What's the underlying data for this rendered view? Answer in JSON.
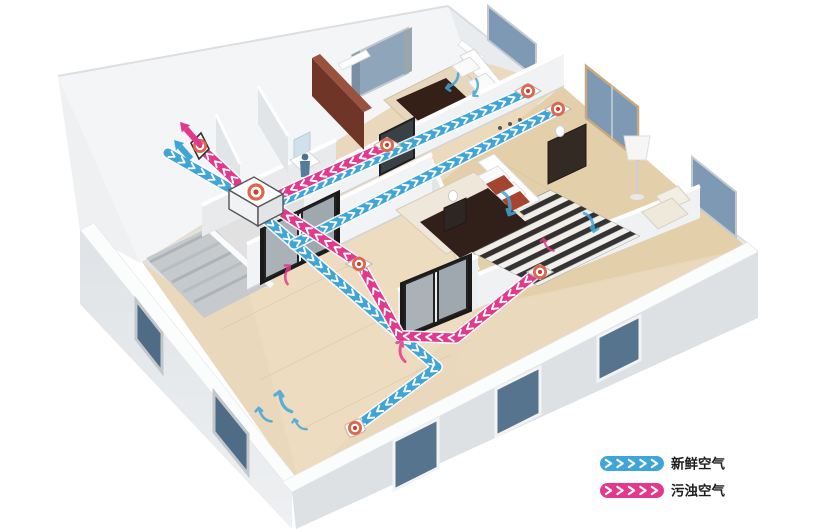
{
  "diagram": {
    "type": "home-ventilation-system-cutaway",
    "colors": {
      "fresh": "#3fa5d8",
      "exhaust": "#e2398c",
      "vent_ring": "#e0654e",
      "vent_dot": "#c9402e",
      "chevron": "#ffffff"
    },
    "legend": {
      "items": [
        {
          "id": "fresh-air",
          "label": "新鲜空气",
          "color": "#3fa5d8"
        },
        {
          "id": "exhaust-air",
          "label": "污浊空气",
          "color": "#e2398c"
        }
      ]
    },
    "unit": {
      "id": "heat-recovery-unit",
      "x": 256,
      "y": 192
    },
    "ducts": [
      {
        "id": "fresh-intake-duct",
        "type": "fresh",
        "points": [
          [
            168,
            153
          ],
          [
            238,
            193
          ]
        ]
      },
      {
        "id": "fresh-supply-living",
        "type": "fresh",
        "points": [
          [
            260,
            214
          ],
          [
            437,
            367
          ],
          [
            356,
            427
          ]
        ]
      },
      {
        "id": "fresh-supply-bedroom1",
        "type": "fresh",
        "points": [
          [
            264,
            209
          ],
          [
            527,
            92
          ]
        ]
      },
      {
        "id": "fresh-supply-bedroom2",
        "type": "fresh",
        "points": [
          [
            294,
            244
          ],
          [
            556,
            110
          ]
        ]
      },
      {
        "id": "exhaust-from-bathroom",
        "type": "exhaust",
        "points": [
          [
            386,
            146
          ],
          [
            268,
            200
          ]
        ]
      },
      {
        "id": "exhaust-from-master",
        "type": "exhaust",
        "points": [
          [
            539,
            271
          ],
          [
            456,
            338
          ],
          [
            400,
            336
          ],
          [
            360,
            264
          ],
          [
            274,
            207
          ]
        ]
      },
      {
        "id": "exhaust-to-outside",
        "type": "exhaust",
        "points": [
          [
            237,
            182
          ],
          [
            204,
            151
          ]
        ]
      }
    ],
    "vents": [
      {
        "id": "outside-wall-vent",
        "style": "wall",
        "x": 200,
        "y": 146
      },
      {
        "id": "bathroom-vent",
        "style": "floor",
        "x": 387,
        "y": 145
      },
      {
        "id": "bedroom1-vent",
        "style": "floor",
        "x": 528,
        "y": 91
      },
      {
        "id": "bedroom2-vent",
        "style": "floor",
        "x": 558,
        "y": 109
      },
      {
        "id": "hallway-vent",
        "style": "floor",
        "x": 359,
        "y": 264
      },
      {
        "id": "master-bedroom-vent",
        "style": "floor",
        "x": 540,
        "y": 272
      },
      {
        "id": "living-room-vent",
        "style": "round",
        "x": 355,
        "y": 428
      }
    ],
    "outdoor_arrows": [
      {
        "id": "exhaust-out-arrow",
        "type": "exhaust",
        "from": [
          201,
          146
        ],
        "to": [
          180,
          122
        ]
      },
      {
        "id": "fresh-in-arrow",
        "type": "fresh",
        "from": [
          191,
          159
        ],
        "to": [
          174,
          140
        ]
      }
    ],
    "room_airflow_arrows": [
      {
        "x": 452,
        "y": 84,
        "rot": 235,
        "type": "fresh",
        "s": 1.0
      },
      {
        "x": 476,
        "y": 90,
        "rot": 205,
        "type": "fresh",
        "s": 0.9
      },
      {
        "x": 509,
        "y": 206,
        "rot": 180,
        "type": "fresh",
        "s": 1.25
      },
      {
        "x": 592,
        "y": 224,
        "rot": 168,
        "type": "fresh",
        "s": 1.1
      },
      {
        "x": 262,
        "y": 414,
        "rot": -28,
        "type": "fresh",
        "s": 1.0
      },
      {
        "x": 282,
        "y": 400,
        "rot": -15,
        "type": "fresh",
        "s": 1.25
      },
      {
        "x": 298,
        "y": 424,
        "rot": -35,
        "type": "fresh",
        "s": 0.85
      },
      {
        "x": 287,
        "y": 272,
        "rot": 22,
        "type": "exhaust",
        "s": 1.0
      },
      {
        "x": 401,
        "y": 349,
        "rot": 6,
        "type": "exhaust",
        "s": 1.1
      },
      {
        "x": 546,
        "y": 244,
        "rot": -25,
        "type": "exhaust",
        "s": 0.85
      }
    ]
  }
}
